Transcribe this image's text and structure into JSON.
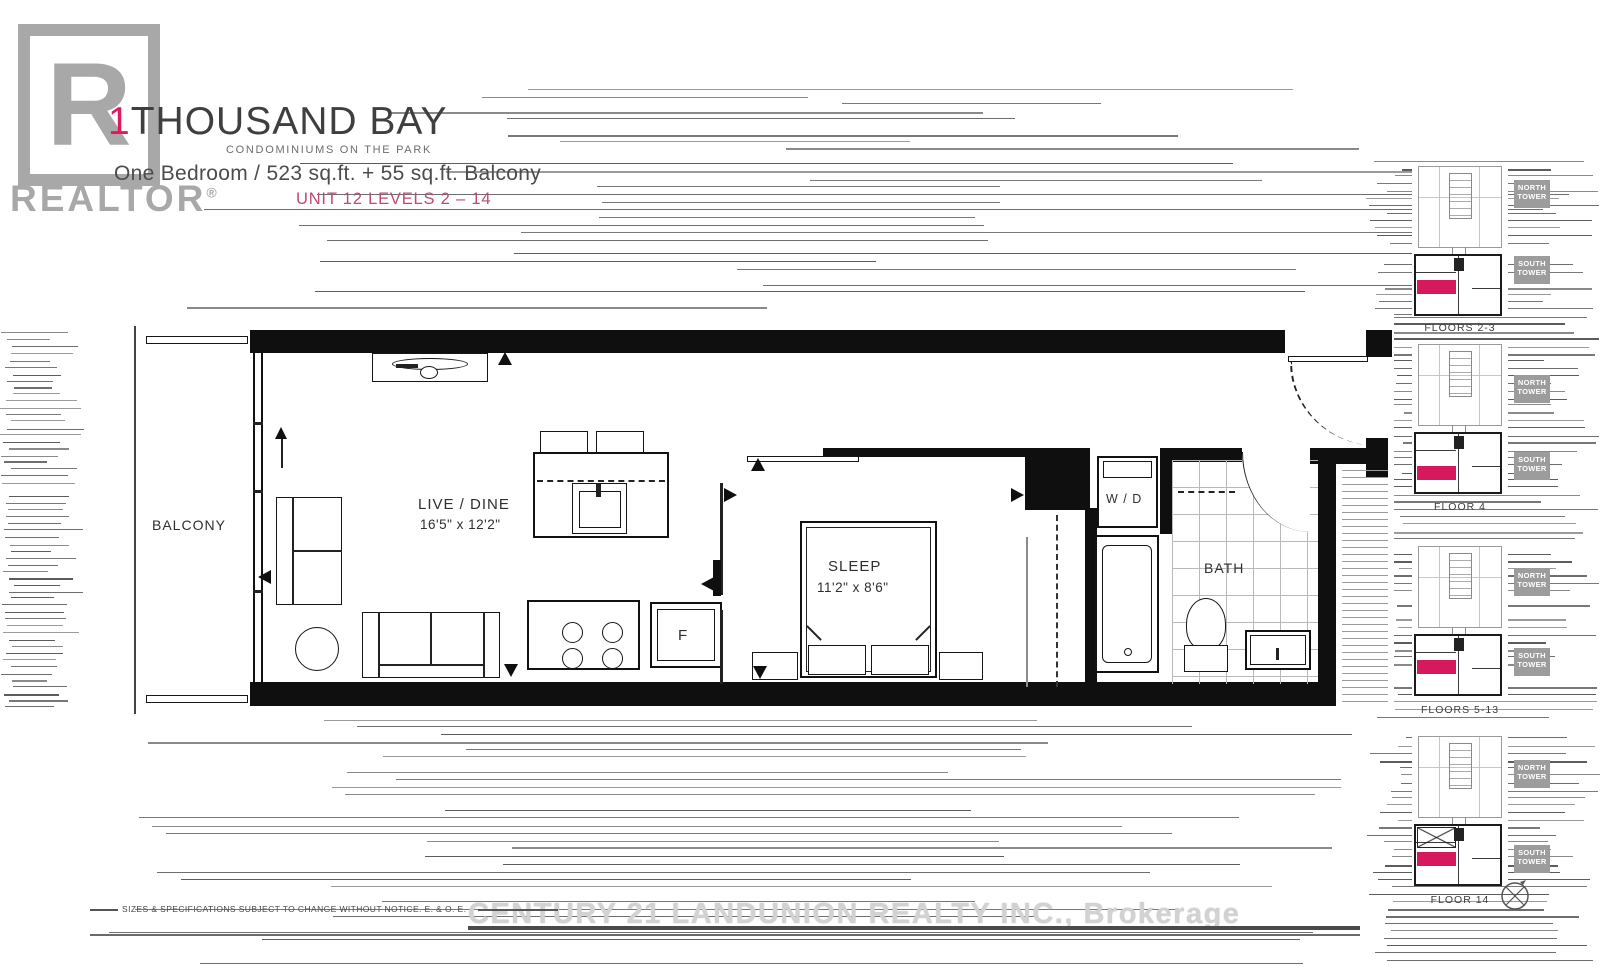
{
  "header": {
    "logo_letter": "R",
    "logo_text": "REALTOR",
    "logo_reg": "®",
    "title_accent": "1",
    "title_rest": "THOUSAND BAY",
    "subtitle": "CONDOMINIUMS ON THE PARK",
    "spec_line": "One Bedroom / 523 sq.ft. + 55 sq.ft. Balcony",
    "unit_line": "UNIT 12 LEVELS 2 – 14"
  },
  "plan": {
    "labels": {
      "balcony": "BALCONY",
      "live_dine": "LIVE / DINE",
      "live_dine_dim": "16'5\" x 12'2\"",
      "sleep": "SLEEP",
      "sleep_dim": "11'2\" x 8'6\"",
      "bath": "BATH",
      "washer_dryer": "W / D",
      "fridge": "F"
    }
  },
  "keyplans": [
    {
      "caption": "FLOORS 2-3",
      "north_label": "NORTH TOWER",
      "south_label": "SOUTH TOWER"
    },
    {
      "caption": "FLOOR 4",
      "north_label": "NORTH TOWER",
      "south_label": "SOUTH TOWER"
    },
    {
      "caption": "FLOORS 5-13",
      "north_label": "NORTH TOWER",
      "south_label": "SOUTH TOWER"
    },
    {
      "caption": "FLOOR 14",
      "north_label": "NORTH TOWER",
      "south_label": "SOUTH TOWER"
    }
  ],
  "footer": {
    "disclaimer": "SIZES & SPECIFICATIONS SUBJECT TO CHANGE WITHOUT NOTICE. E. & O. E.",
    "watermark": "CENTURY 21 LANDUNION REALTY INC., Brokerage"
  },
  "colors": {
    "accent_pink": "#D6195C",
    "unit_text_pink": "#BE4A70",
    "logo_gray": "#A8A8A8",
    "tower_label_gray": "#9C9C9C"
  }
}
